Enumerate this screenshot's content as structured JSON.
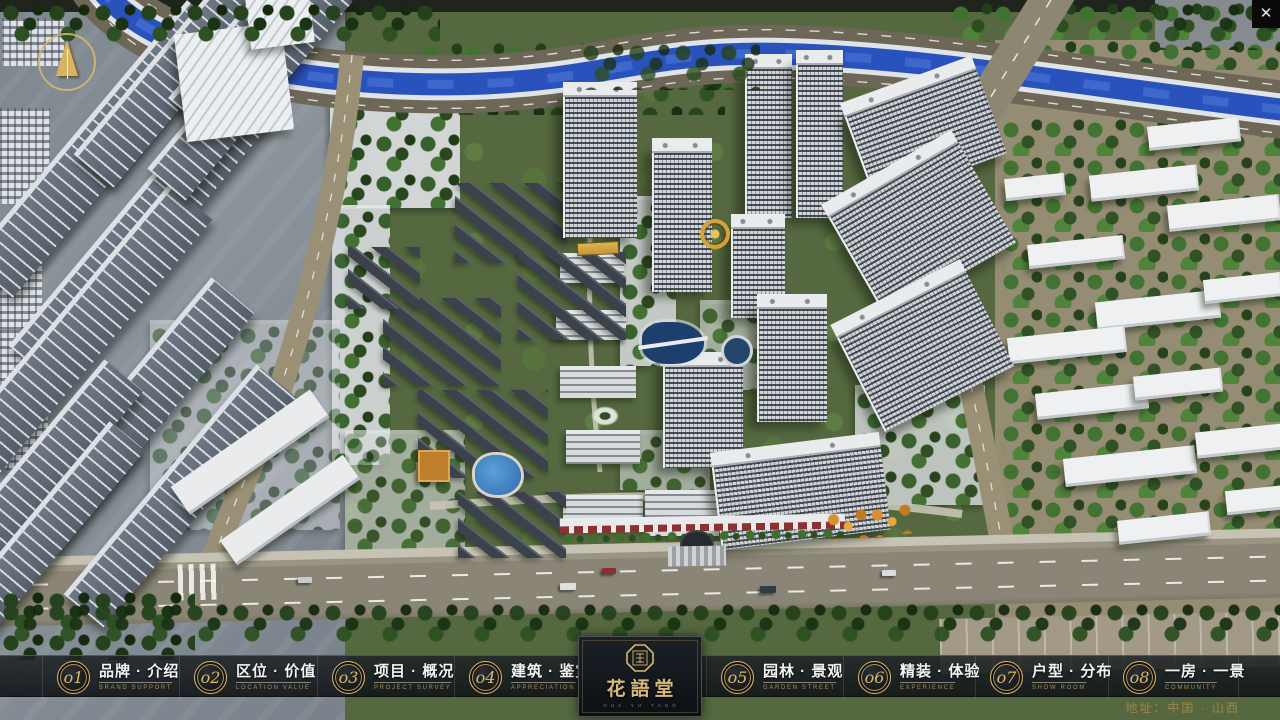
{
  "nav": {
    "items": [
      {
        "num": "o1",
        "label": "品牌 · 介绍",
        "sub": "BRAND SUPPORT",
        "left": 42,
        "width": 137
      },
      {
        "num": "o2",
        "label": "区位 · 价值",
        "sub": "LOCATION VALUE",
        "left": 179,
        "width": 138
      },
      {
        "num": "o3",
        "label": "项目 · 概况",
        "sub": "PROJECT SURVEY",
        "left": 317,
        "width": 137
      },
      {
        "num": "o4",
        "label": "建筑 · 鉴赏",
        "sub": "APPRECIATION",
        "left": 454,
        "width": 138
      },
      {
        "num": "o5",
        "label": "园林 · 景观",
        "sub": "GARDEN STREET",
        "left": 706,
        "width": 137
      },
      {
        "num": "o6",
        "label": "精装 · 体验",
        "sub": "EXPERIENCE",
        "left": 843,
        "width": 132
      },
      {
        "num": "o7",
        "label": "户型 · 分布",
        "sub": "SHOW ROOM",
        "left": 975,
        "width": 133
      },
      {
        "num": "o8",
        "label": "一房 · 一景",
        "sub": "COMMUNITY",
        "left": 1108,
        "width": 130
      }
    ]
  },
  "logo": {
    "title": "花語堂",
    "subtext": "H U A · Y U · T A N G"
  },
  "footer": {
    "address": "地址：中国 · 山西"
  },
  "chrome": {
    "close_label": "✕"
  },
  "colors": {
    "gold": "#d8b86a",
    "gold_dim": "#a6824a",
    "bar_bg": "#14181c",
    "river": "#2a52bd"
  },
  "scene": {
    "towers": [
      [
        563,
        92,
        74,
        146
      ],
      [
        652,
        148,
        60,
        144
      ],
      [
        745,
        64,
        47,
        154
      ],
      [
        796,
        60,
        47,
        158
      ],
      [
        731,
        224,
        54,
        94
      ],
      [
        663,
        362,
        80,
        106
      ],
      [
        757,
        304,
        70,
        118
      ]
    ],
    "towersRot": [
      [
        855,
        86,
        140,
        94,
        -20
      ],
      [
        846,
        168,
        150,
        120,
        -30
      ],
      [
        852,
        295,
        145,
        110,
        -27
      ],
      [
        716,
        452,
        170,
        88,
        -7
      ]
    ],
    "midSlabs": [
      [
        560,
        253,
        64,
        30
      ],
      [
        556,
        310,
        70,
        30
      ],
      [
        560,
        366,
        76,
        32
      ],
      [
        566,
        430,
        74,
        34
      ],
      [
        563,
        495,
        80,
        34
      ],
      [
        645,
        490,
        74,
        46
      ]
    ],
    "courtyards": [
      [
        455,
        183,
        112,
        80
      ],
      [
        518,
        252,
        108,
        88
      ],
      [
        383,
        298,
        118,
        88
      ],
      [
        418,
        390,
        130,
        88
      ],
      [
        348,
        247,
        72,
        62
      ],
      [
        458,
        492,
        108,
        66
      ]
    ],
    "leftSlabs": [
      [
        -70,
        120,
        340,
        58
      ],
      [
        -30,
        205,
        340,
        58
      ],
      [
        -80,
        300,
        330,
        56
      ],
      [
        -30,
        390,
        320,
        56
      ],
      [
        30,
        470,
        300,
        52
      ],
      [
        40,
        30,
        300,
        52
      ],
      [
        140,
        -10,
        260,
        48
      ],
      [
        -90,
        450,
        260,
        50
      ],
      [
        -70,
        505,
        240,
        46
      ],
      [
        120,
        60,
        260,
        50
      ]
    ],
    "leftSlabsWhite": [
      [
        165,
        435,
        170,
        34
      ],
      [
        215,
        495,
        150,
        30
      ]
    ],
    "rightSlabs": [
      [
        1090,
        170,
        108,
        26
      ],
      [
        1028,
        240,
        96,
        24
      ],
      [
        1168,
        200,
        112,
        26
      ],
      [
        1096,
        296,
        124,
        28
      ],
      [
        1008,
        332,
        118,
        26
      ],
      [
        1204,
        276,
        78,
        24
      ],
      [
        1036,
        388,
        112,
        26
      ],
      [
        1134,
        372,
        88,
        24
      ],
      [
        1064,
        452,
        132,
        28
      ],
      [
        1196,
        428,
        88,
        26
      ],
      [
        1226,
        488,
        62,
        24
      ],
      [
        1118,
        516,
        92,
        24
      ],
      [
        1148,
        122,
        92,
        24
      ],
      [
        1005,
        176,
        60,
        22
      ]
    ],
    "farLeftTowers": [
      [
        0,
        108,
        50,
        96
      ],
      [
        0,
        255,
        42,
        74
      ],
      [
        0,
        330,
        40,
        66
      ],
      [
        0,
        412,
        48,
        58
      ],
      [
        2,
        18,
        62,
        48
      ]
    ],
    "bigWhite": [
      [
        180,
        28,
        108,
        108,
        -7
      ],
      [
        248,
        -6,
        64,
        52,
        -7
      ]
    ],
    "treesUnder": [
      [
        330,
        88,
        130,
        120,
        "mid",
        0.95
      ],
      [
        332,
        205,
        58,
        260,
        "mid",
        0.9
      ],
      [
        620,
        196,
        56,
        170,
        "mid",
        0.85
      ],
      [
        855,
        385,
        130,
        120,
        "mid",
        0.8
      ],
      [
        1000,
        118,
        282,
        440,
        "lush",
        0.95
      ],
      [
        150,
        320,
        190,
        210,
        "mid",
        0.45
      ],
      [
        345,
        430,
        120,
        120,
        "mid",
        0.6
      ],
      [
        700,
        300,
        70,
        90,
        "mid",
        0.6
      ],
      [
        620,
        430,
        90,
        60,
        "mid",
        0.6
      ],
      [
        900,
        60,
        70,
        200,
        "mid",
        0.5
      ],
      [
        420,
        42,
        340,
        48,
        "lush",
        1
      ],
      [
        950,
        2,
        330,
        68,
        "lush",
        1
      ],
      [
        455,
        60,
        270,
        55,
        "dark",
        0.9
      ]
    ],
    "treesOver": [
      [
        0,
        0,
        440,
        46,
        "dark",
        1
      ],
      [
        1150,
        0,
        130,
        50,
        "dark",
        0.95
      ],
      [
        580,
        40,
        180,
        50,
        "dark",
        0.8
      ],
      [
        0,
        588,
        195,
        72,
        "dark",
        1
      ],
      [
        0,
        600,
        1280,
        46,
        "dark",
        0.95
      ]
    ],
    "cars": [
      [
        560,
        583,
        16,
        7,
        "#dde1e4"
      ],
      [
        602,
        568,
        14,
        6,
        "#8a2e2e"
      ],
      [
        760,
        586,
        16,
        7,
        "#2e3a45"
      ],
      [
        882,
        570,
        14,
        6,
        "#d8dde0"
      ],
      [
        298,
        577,
        14,
        6,
        "#c8ccd1"
      ]
    ]
  }
}
